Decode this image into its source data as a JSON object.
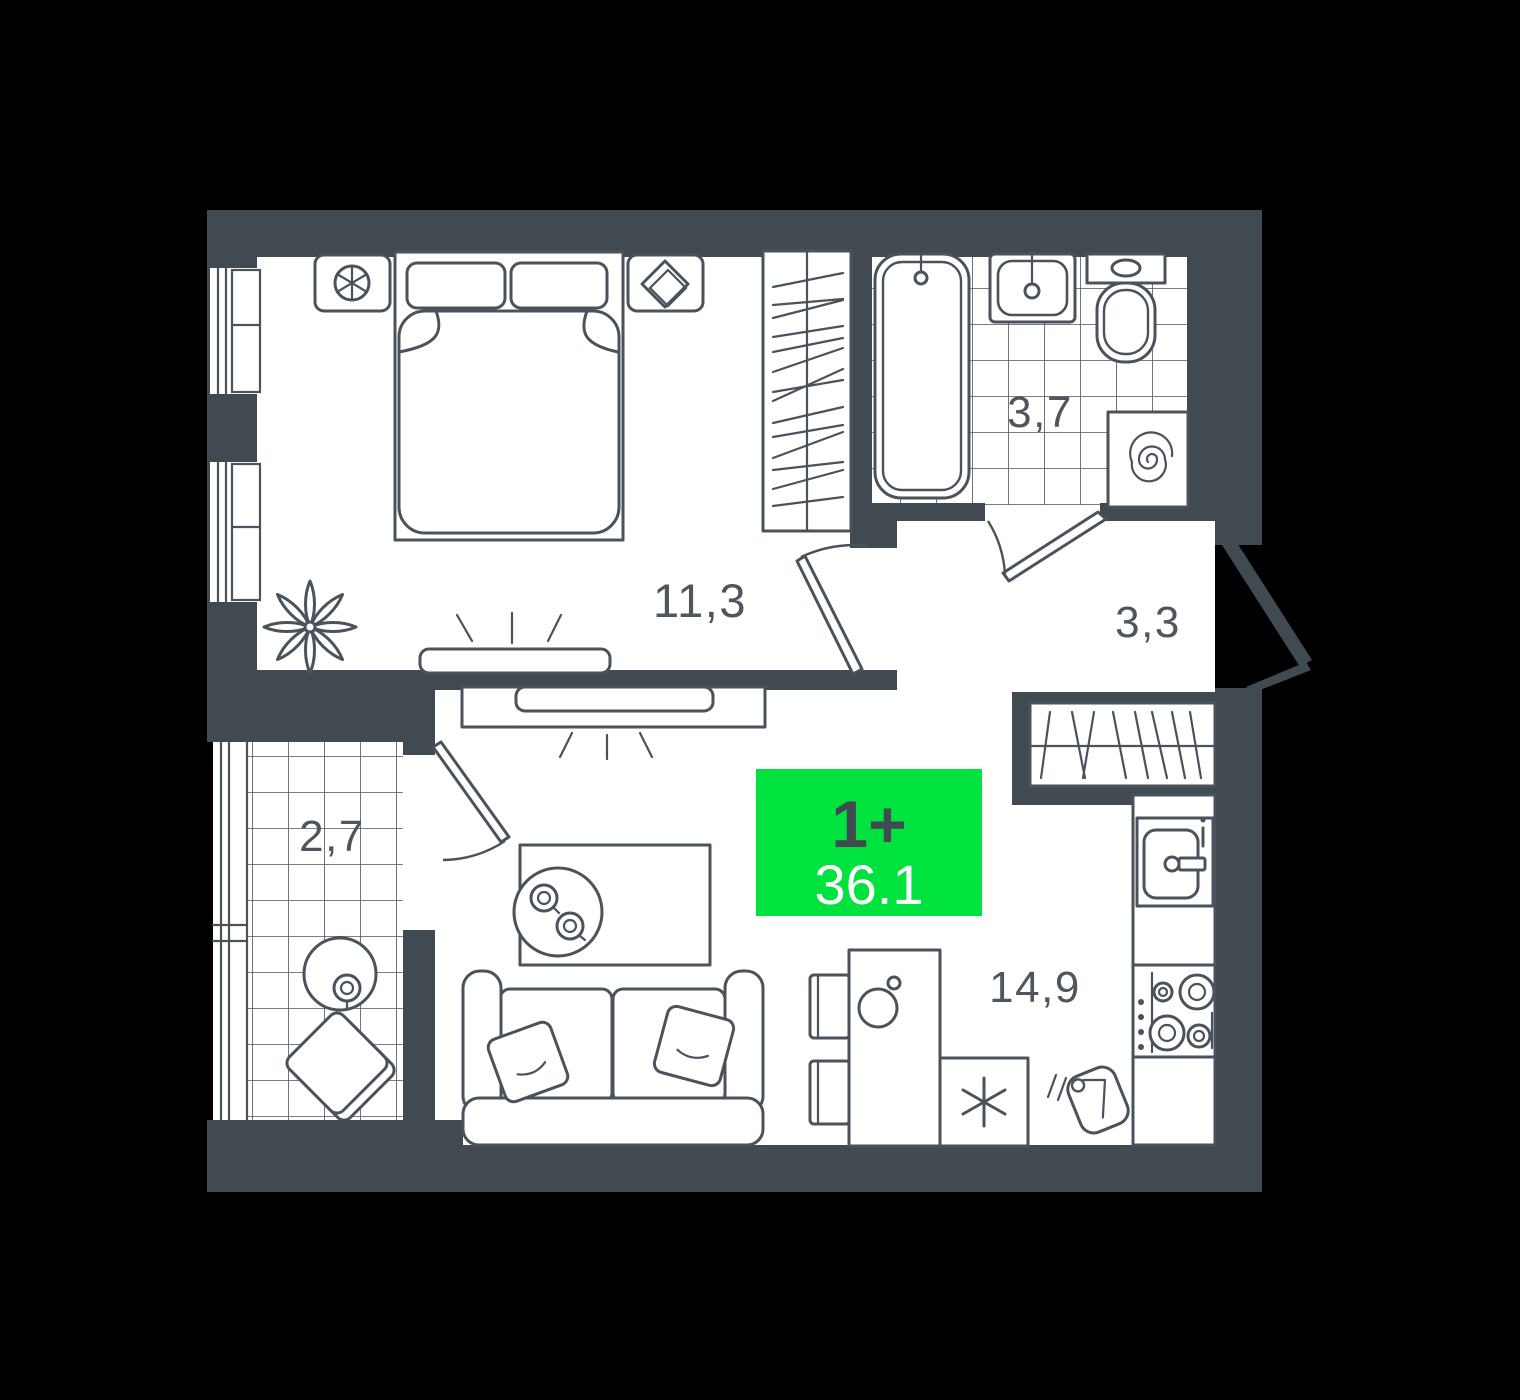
{
  "plan": {
    "title": "1-room apartment floor plan",
    "badge": {
      "type": "1+",
      "area": "36.1",
      "bg_color": "#00E23E",
      "type_text_color": "#414A50",
      "area_text_color": "#FFFFFF"
    },
    "rooms": [
      {
        "id": "bedroom",
        "area_label": "11,3"
      },
      {
        "id": "bathroom",
        "area_label": "3,7"
      },
      {
        "id": "hallway",
        "area_label": "3,3"
      },
      {
        "id": "balcony",
        "area_label": "2,7"
      },
      {
        "id": "kitchen-living",
        "area_label": "14,9"
      }
    ],
    "colors": {
      "wall": "#424A51",
      "furniture_line": "#4A535B",
      "room_fill": "#FFFFFF",
      "label_text": "#4E565E",
      "background": "#000000"
    },
    "icons": {
      "bed": "double-bed-top-view",
      "wardrobe": "hanger-rail",
      "bathtub": "bathtub-top-view",
      "washbasin": "sink-top-view",
      "toilet": "toilet-top-view",
      "washing_machine": "spiral-drum",
      "closet": "hanger-rail",
      "sofa": "two-seat-sofa",
      "tv": "flat-tv-with-signal-rays",
      "fridge": "snowflake-asterisk",
      "stove": "four-burner-cooktop",
      "kitchen_sink": "single-bowl-sink",
      "dining_table": "table-with-kettle",
      "chair": "side-chair",
      "plant": "flower-top-view",
      "balcony_table": "round-table-with-cup",
      "balcony_chair": "diamond-chair",
      "cutting_board": "board-with-knife"
    }
  }
}
